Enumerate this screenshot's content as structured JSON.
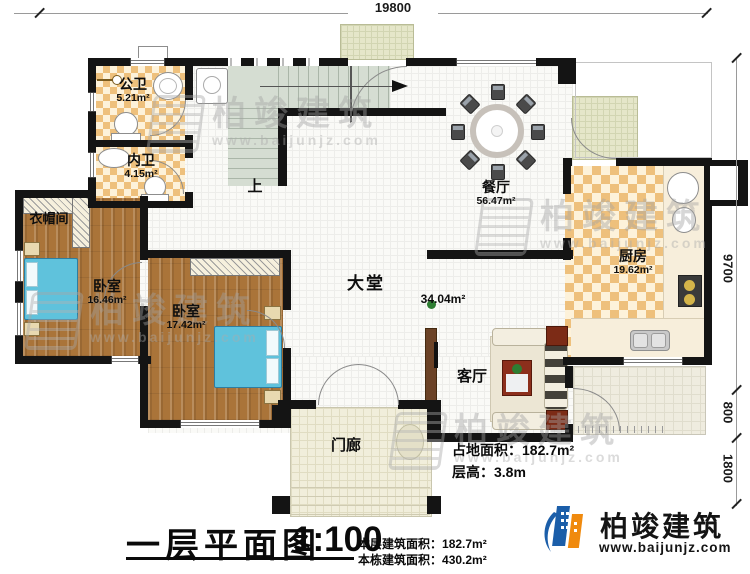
{
  "dimensions": {
    "width_top": "19800",
    "right": [
      "9700",
      "800",
      "1800"
    ]
  },
  "rooms": {
    "gongwei": {
      "name": "公卫",
      "area": "5.21m²"
    },
    "neiwei": {
      "name": "内卫",
      "area": "4.15m²"
    },
    "yimaojian": {
      "name": "衣帽间"
    },
    "woshi1": {
      "name": "卧室",
      "area": "16.46m²"
    },
    "woshi2": {
      "name": "卧室",
      "area": "17.42m²"
    },
    "datang": {
      "name": "大堂",
      "area": "34.04m²"
    },
    "canting": {
      "name": "餐厅",
      "area": "56.47m²"
    },
    "chufang": {
      "name": "厨房",
      "area": "19.62m²"
    },
    "keting": {
      "name": "客厅"
    },
    "menlang": {
      "name": "门廊"
    }
  },
  "stairs": {
    "up_label": "上"
  },
  "info": {
    "site_area_label": "占地面积：",
    "site_area_value": "182.7m²",
    "height_label": "层高：",
    "height_value": "3.8m"
  },
  "titleblock": {
    "title": "一层平面图",
    "scale": "1:100",
    "floor_area_label": "本层建筑面积：",
    "floor_area_value": "182.7m²",
    "building_area_label": "本栋建筑面积：",
    "building_area_value": "430.2m²"
  },
  "brand": {
    "name": "柏竣建筑",
    "url": "www.baijunjz.com"
  },
  "watermark": {
    "name": "柏竣建筑",
    "url": "www.baijunjz.com"
  },
  "colors": {
    "wall": "#141414",
    "tile_accent": "#eec07c",
    "wood_floor": "#aa7439",
    "bed_blue": "#5fc2dc",
    "stair_green": "#d5ddd2",
    "brand_blue": "#1b5ea9",
    "brand_orange": "#f08a0e"
  }
}
